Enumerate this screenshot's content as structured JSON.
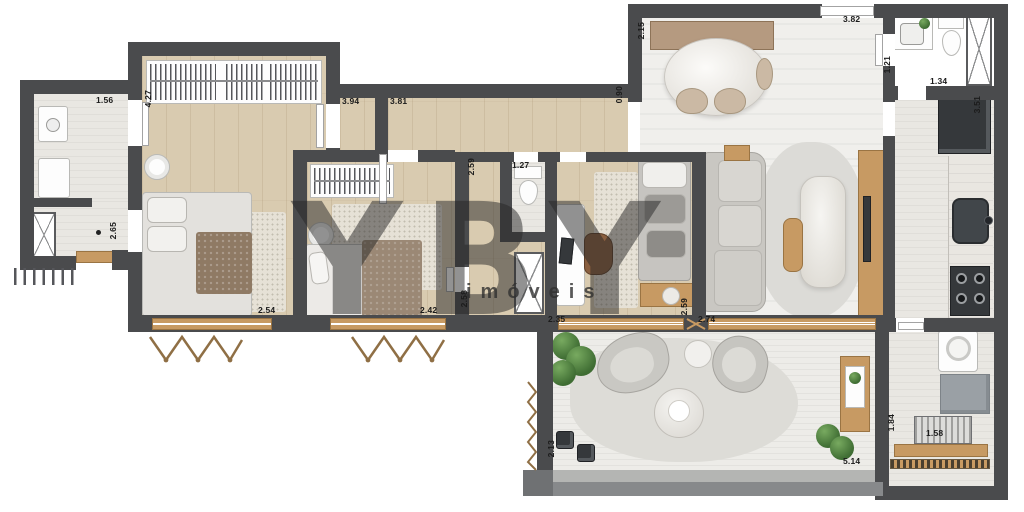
{
  "watermark": {
    "brand": "YBY",
    "tagline": "imóveis"
  },
  "colors": {
    "wall": "#4a4b4d",
    "wood_floor": "#d9cbb0",
    "tile_floor": "#f0efec",
    "bath_floor": "#e9e7e2",
    "terrace_floor": "#edece8",
    "rug": "#e6e1d6",
    "wood_furniture": "#c79a63",
    "dark_appliance": "#35383b",
    "plant_green": "#4f7c3c",
    "label_text": "#1b1b1b"
  },
  "dimensions": [
    {
      "text": "1.56",
      "x": 96,
      "y": 95,
      "v": 0
    },
    {
      "text": "4.27",
      "x": 143,
      "y": 90,
      "v": 1
    },
    {
      "text": "2.65",
      "x": 108,
      "y": 222,
      "v": 1
    },
    {
      "text": "3.94",
      "x": 342,
      "y": 96,
      "v": 0
    },
    {
      "text": "3.81",
      "x": 390,
      "y": 96,
      "v": 0
    },
    {
      "text": "0.90",
      "x": 614,
      "y": 86,
      "v": 1
    },
    {
      "text": "2.15",
      "x": 636,
      "y": 22,
      "v": 1
    },
    {
      "text": "3.82",
      "x": 843,
      "y": 14,
      "v": 0
    },
    {
      "text": "1.21",
      "x": 882,
      "y": 56,
      "v": 1
    },
    {
      "text": "1.34",
      "x": 930,
      "y": 76,
      "v": 0
    },
    {
      "text": "3.51",
      "x": 972,
      "y": 96,
      "v": 1
    },
    {
      "text": "2.54",
      "x": 258,
      "y": 305,
      "v": 0
    },
    {
      "text": "2.42",
      "x": 420,
      "y": 305,
      "v": 0
    },
    {
      "text": "2.59",
      "x": 466,
      "y": 158,
      "v": 1
    },
    {
      "text": "2.58",
      "x": 459,
      "y": 290,
      "v": 1
    },
    {
      "text": "1.27",
      "x": 512,
      "y": 160,
      "v": 0
    },
    {
      "text": "2.35",
      "x": 548,
      "y": 314,
      "v": 0
    },
    {
      "text": "2.59",
      "x": 679,
      "y": 298,
      "v": 1
    },
    {
      "text": "2.74",
      "x": 698,
      "y": 314,
      "v": 0
    },
    {
      "text": "2.13",
      "x": 546,
      "y": 440,
      "v": 1
    },
    {
      "text": "5.14",
      "x": 843,
      "y": 456,
      "v": 0
    },
    {
      "text": "1.84",
      "x": 886,
      "y": 414,
      "v": 1
    },
    {
      "text": "1.58",
      "x": 926,
      "y": 428,
      "v": 0
    }
  ]
}
